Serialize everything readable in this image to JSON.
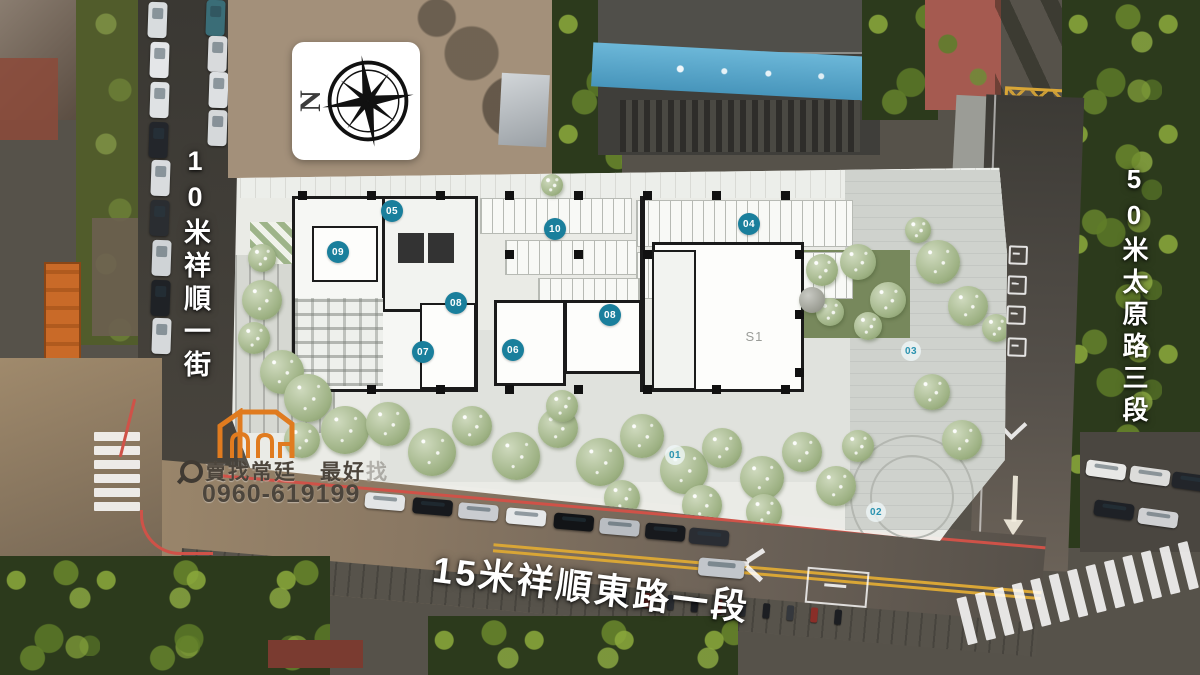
{
  "streets": {
    "left": "10米祥順一街",
    "right": "50米太原路三段",
    "bottom": "15米祥順東路一段"
  },
  "compass": {
    "letter": "N"
  },
  "branding": {
    "icon": "magnifier-icon",
    "line": "賣找常廷　最好",
    "line_faded_char": "找",
    "phone": "0960-619199",
    "logo_color": "#e07b1f"
  },
  "plan": {
    "unit_label": "S1",
    "markers": [
      {
        "label": "05",
        "style": "filled"
      },
      {
        "label": "10",
        "style": "filled"
      },
      {
        "label": "04",
        "style": "filled"
      },
      {
        "label": "09",
        "style": "filled"
      },
      {
        "label": "08",
        "style": "filled"
      },
      {
        "label": "08",
        "style": "filled"
      },
      {
        "label": "07",
        "style": "filled"
      },
      {
        "label": "06",
        "style": "filled"
      },
      {
        "label": "03",
        "style": "outline"
      },
      {
        "label": "01",
        "style": "outline"
      },
      {
        "label": "02",
        "style": "outline"
      }
    ]
  },
  "colors": {
    "marker_filled_bg": "#1a7f9c",
    "marker_outline_text": "#2a93b0",
    "curb_red": "#cf5248",
    "road_yellow": "#d9a636",
    "banner_blue": "#5aaed2"
  }
}
